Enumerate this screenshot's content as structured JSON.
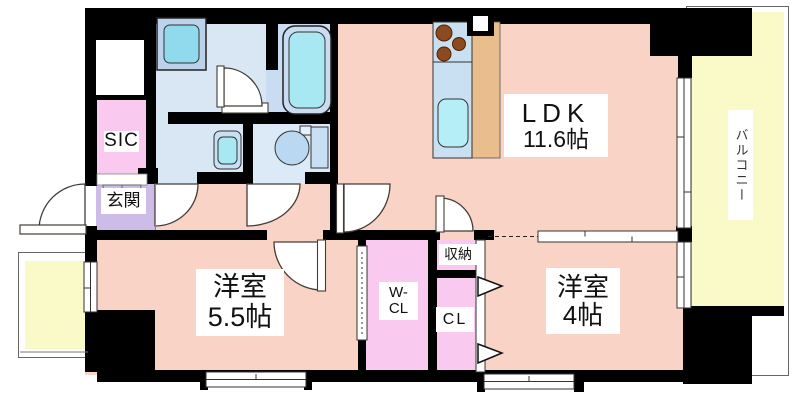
{
  "floorplan": {
    "rooms": {
      "ldk": {
        "name": "LDK",
        "size": "11.6帖"
      },
      "bedroom_a": {
        "name": "洋室",
        "size": "5.5帖"
      },
      "bedroom_b": {
        "name": "洋室",
        "size": "4帖"
      },
      "balcony": {
        "name": "バルコニー"
      },
      "entrance": {
        "name": "玄関"
      },
      "shoes_in_closet": {
        "name": "SIC"
      },
      "walk_in_closet": {
        "name_line1": "W-",
        "name_line2": "CL"
      },
      "closet": {
        "name": "CL"
      },
      "storage": {
        "name": "収納"
      }
    },
    "fixtures": [
      "washing-machine",
      "bathtub",
      "toilet",
      "washbasin",
      "kitchen-counter",
      "kitchen-sink",
      "stove-burners",
      "range-hood"
    ],
    "colors": {
      "wall": "#000000",
      "living_rooms": "#F8D3C6",
      "closets": "#F9C9EF",
      "entrance": "#CDBCE8",
      "wet_area": "#D9E7F5",
      "balcony": "#FAFAC8",
      "kitchen_counter_top": "#C8E0F2",
      "kitchen_counter_wood": "#E9BE8C",
      "water_cyan": "#A8E8F2"
    }
  }
}
